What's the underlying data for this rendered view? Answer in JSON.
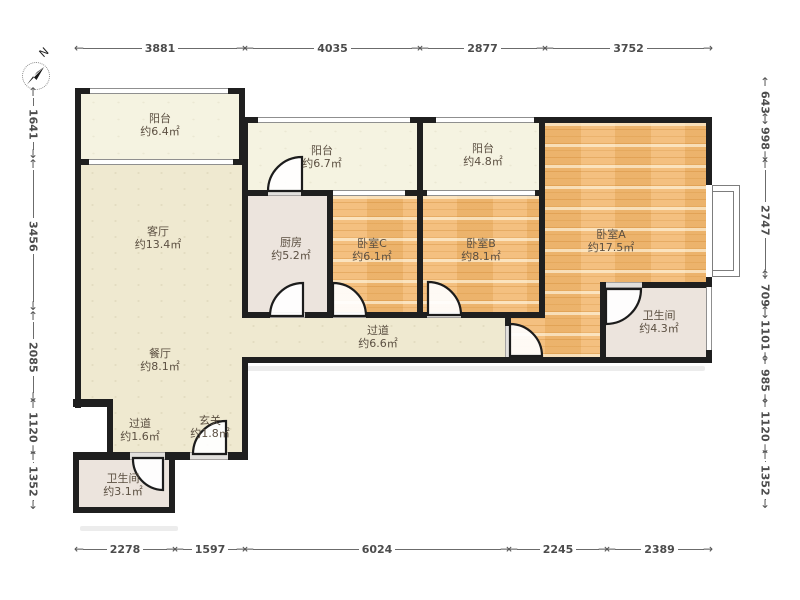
{
  "compass": {
    "north_label": "N"
  },
  "icons": {
    "arrow_left": "←",
    "arrow_right": "→",
    "arrow_up": "↑",
    "arrow_down": "↓"
  },
  "rooms": [
    {
      "name": "阳台",
      "area": "约6.4㎡"
    },
    {
      "name": "客厅",
      "area": "约13.4㎡"
    },
    {
      "name": "餐厅",
      "area": "约8.1㎡"
    },
    {
      "name": "过道",
      "area": "约1.6㎡"
    },
    {
      "name": "玄关",
      "area": "约1.8㎡"
    },
    {
      "name": "卫生间",
      "area": "约3.1㎡"
    },
    {
      "name": "厨房",
      "area": "约5.2㎡"
    },
    {
      "name": "阳台",
      "area": "约6.7㎡"
    },
    {
      "name": "卧室C",
      "area": "约6.1㎡"
    },
    {
      "name": "阳台",
      "area": "约4.8㎡"
    },
    {
      "name": "卧室B",
      "area": "约8.1㎡"
    },
    {
      "name": "卧室A",
      "area": "约17.5㎡"
    },
    {
      "name": "卫生间",
      "area": "约4.3㎡"
    },
    {
      "name": "过道",
      "area": "约6.6㎡"
    }
  ],
  "dimensions": {
    "top": [
      {
        "label": "3881"
      },
      {
        "label": "4035"
      },
      {
        "label": "2877"
      },
      {
        "label": "3752"
      }
    ],
    "bottom": [
      {
        "label": "2278"
      },
      {
        "label": "1597"
      },
      {
        "label": "6024"
      },
      {
        "label": "2245"
      },
      {
        "label": "2389"
      }
    ],
    "left": [
      {
        "label": "1641"
      },
      {
        "label": "3456"
      },
      {
        "label": "2085"
      },
      {
        "label": "1120"
      },
      {
        "label": "1352"
      }
    ],
    "right": [
      {
        "label": "643"
      },
      {
        "label": "998"
      },
      {
        "label": "2747"
      },
      {
        "label": "709"
      },
      {
        "label": "1101"
      },
      {
        "label": "985"
      },
      {
        "label": "1120"
      },
      {
        "label": "1352"
      }
    ]
  },
  "colors": {
    "wood_floor": "#f2b76e",
    "living_floor": "#efe9d0",
    "balcony_floor": "#f5f3e1",
    "wet_room_floor": "#ece4dd",
    "wall": "#1f1f1f"
  }
}
